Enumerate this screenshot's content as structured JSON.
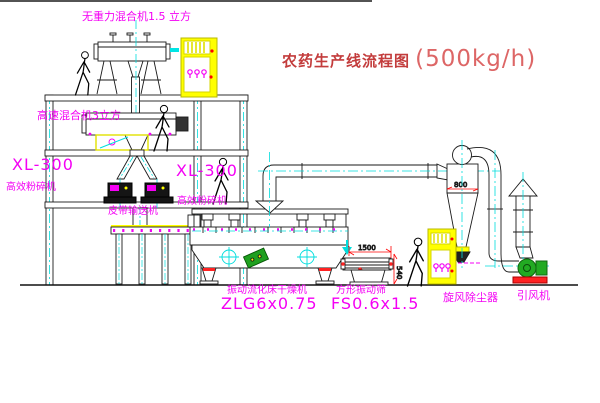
{
  "title": {
    "main": "农药生产线流程图",
    "capacity": "(500kg/h)"
  },
  "labels": {
    "top_mixer": "无重力混合机1.5 立方",
    "floor2_mixer": "高速混合机3立方",
    "left_crusher_model": "XL-300",
    "left_crusher_name": "高效粉碎机",
    "mid_crusher_model": "XL-300",
    "mid_crusher_name": "高效粉碎机",
    "belt_conveyor": "皮带输送机",
    "dryer_name": "振动流化床干燥机",
    "dryer_model": "ZLG6x0.75",
    "screen_name": "方形振动筛",
    "screen_model": "FS0.6x1.5",
    "cyclone": "旋风除尘器",
    "fan": "引风机"
  },
  "dimensions": {
    "cyclone_width": "800",
    "screen_length": "1500",
    "screen_height": "540"
  },
  "colors": {
    "label_magenta": "#f400f4",
    "title_red": "#c33c3c",
    "line_black": "#1a1a1a",
    "centerline_cyan": "#00dddd",
    "equipment_yellow": "#ffff00",
    "fan_green": "#22aa22",
    "dimension_red": "#ff0000"
  }
}
